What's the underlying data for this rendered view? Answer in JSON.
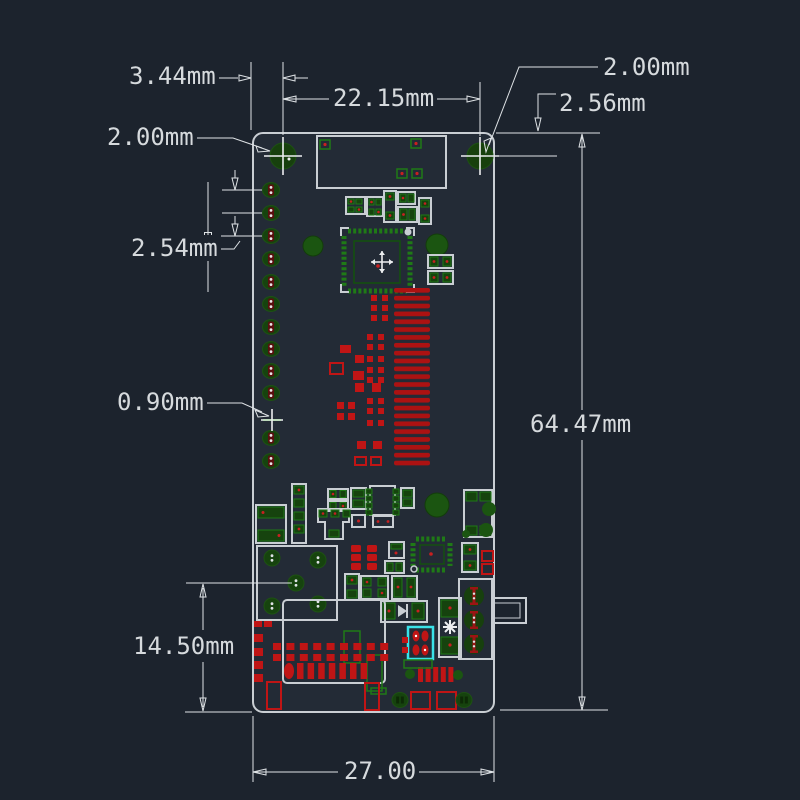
{
  "drawing": {
    "type": "pcb-dimension-drawing",
    "dimensions": {
      "left_hole_offset_x": "3.44mm",
      "hole_spacing": "22.15mm",
      "left_hole_label": "2.00mm",
      "right_hole_label": "2.00mm",
      "hole_offset_y": "2.56mm",
      "pin_pitch": "2.54mm",
      "small_hole": "0.90mm",
      "board_height": "64.47mm",
      "connector_offset": "14.50mm",
      "board_width": "27.00"
    },
    "colors": {
      "background": "#1c232d",
      "board_fill": "#232b36",
      "silkscreen_white": "#c9ced3",
      "dimension_line": "#dfe3e6",
      "label_text": "#d6dadd",
      "pad_green_dark": "#16430e",
      "pad_green_bright": "#1f7a16",
      "copper_red": "#c01515",
      "highlight_cyan": "#3ae2e8"
    }
  }
}
